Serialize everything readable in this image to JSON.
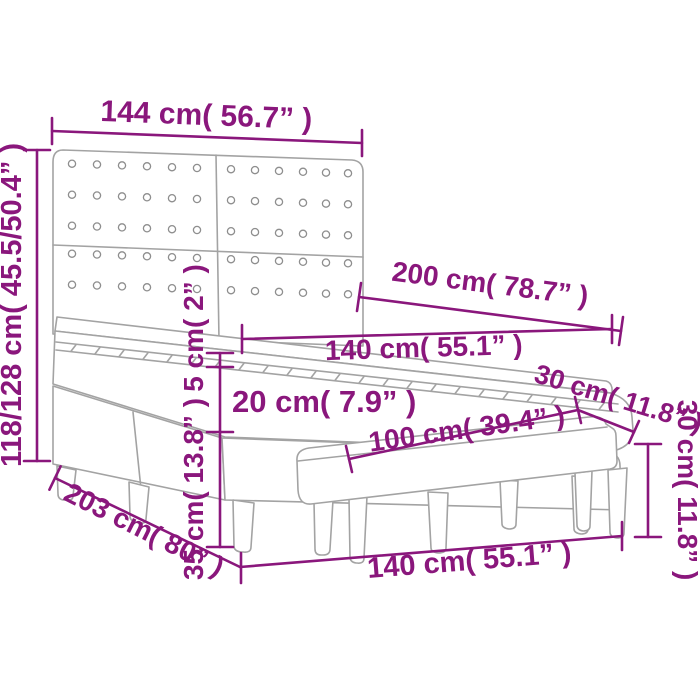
{
  "meta": {
    "title": "Box spring bed with headboard and bench - dimension diagram",
    "accent_color": "#8a177c",
    "art_color": "#a3a3a3",
    "background": "#ffffff"
  },
  "labels": {
    "headboard_width": "144 cm( 56.7” )",
    "total_height": "118/128 cm( 45.5/50.4” )",
    "bed_length": "200 cm( 78.7” )",
    "mattress_width": "140 cm( 55.1” )",
    "topper_height": "5 cm( 2” )",
    "mattress_height": "20 cm( 7.9” )",
    "bench_depth": "30 cm( 11.8” )",
    "bench_length": "100 cm( 39.4” )",
    "base_leg_height": "35 cm( 13.8” )",
    "frame_length": "203 cm( 80” )",
    "bed_width": "140 cm( 55.1” )",
    "bench_height": "30 cm( 11.8” )"
  }
}
